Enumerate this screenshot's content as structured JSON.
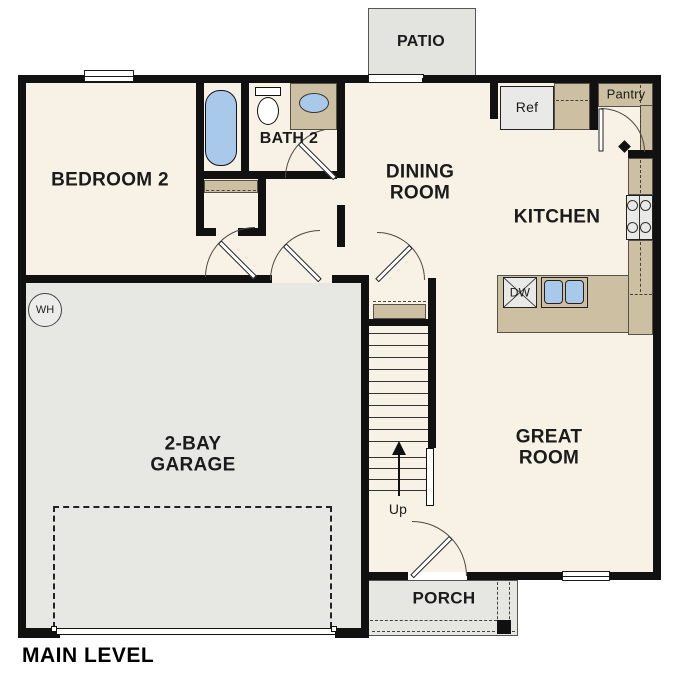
{
  "plan_title": "MAIN LEVEL",
  "rooms": {
    "bedroom2": "BEDROOM 2",
    "bath2": "BATH 2",
    "dining": "DINING\nROOM",
    "kitchen": "KITCHEN",
    "great_room": "GREAT\nROOM",
    "garage": "2-BAY\nGARAGE",
    "porch": "PORCH",
    "patio": "PATIO"
  },
  "labels": {
    "refrigerator": "Ref",
    "pantry": "Pantry",
    "dishwasher": "DW",
    "stairs_direction": "Up",
    "water_heater": "WH"
  },
  "colors": {
    "floor": "#f8f1e5",
    "garage_floor": "#e7e7e4",
    "patio_floor": "#e3e3e0",
    "porch_floor": "#e6e6e3",
    "counter": "#cdbfa2",
    "fixture_blue": "#a9c9ea",
    "wall": "#111111",
    "appliance": "#e9e9e7"
  }
}
